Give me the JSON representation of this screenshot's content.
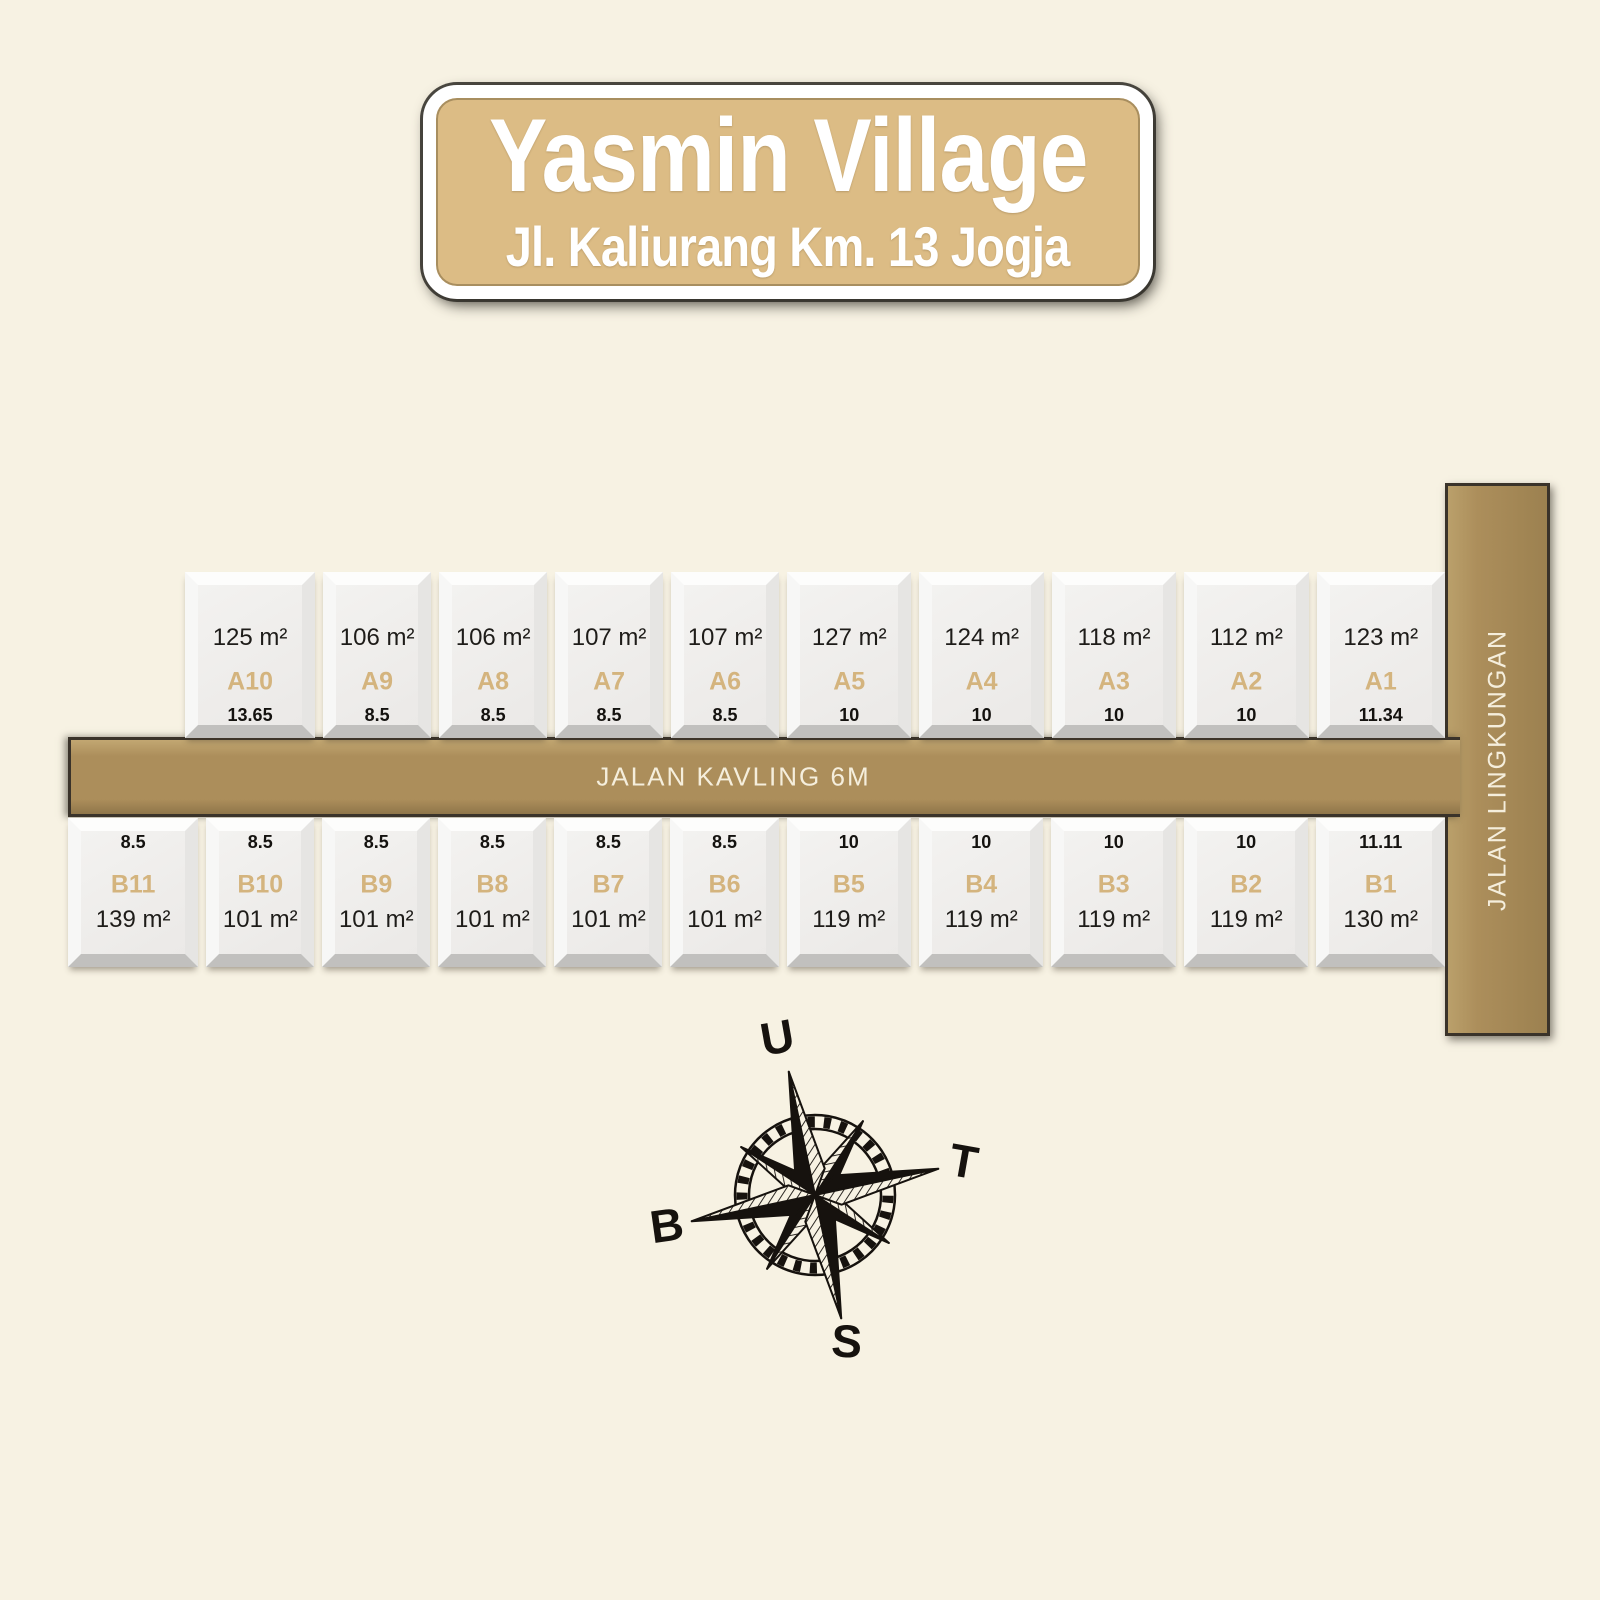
{
  "banner": {
    "title": "Yasmin Village",
    "subtitle": "Jl. Kaliurang Km. 13 Jogja"
  },
  "roads": {
    "horizontal_label": "JALAN KAVLING 6M",
    "vertical_label": "JALAN LINGKUNGAN"
  },
  "plot_rows": {
    "a": [
      {
        "id": "A10",
        "area": "125 m²",
        "frontage": "13.65"
      },
      {
        "id": "A9",
        "area": "106 m²",
        "frontage": "8.5"
      },
      {
        "id": "A8",
        "area": "106 m²",
        "frontage": "8.5"
      },
      {
        "id": "A7",
        "area": "107 m²",
        "frontage": "8.5"
      },
      {
        "id": "A6",
        "area": "107 m²",
        "frontage": "8.5"
      },
      {
        "id": "A5",
        "area": "127 m²",
        "frontage": "10"
      },
      {
        "id": "A4",
        "area": "124 m²",
        "frontage": "10"
      },
      {
        "id": "A3",
        "area": "118 m²",
        "frontage": "10"
      },
      {
        "id": "A2",
        "area": "112 m²",
        "frontage": "10"
      },
      {
        "id": "A1",
        "area": "123 m²",
        "frontage": "11.34"
      }
    ],
    "b": [
      {
        "id": "B11",
        "area": "139 m²",
        "frontage": "8.5"
      },
      {
        "id": "B10",
        "area": "101 m²",
        "frontage": "8.5"
      },
      {
        "id": "B9",
        "area": "101 m²",
        "frontage": "8.5"
      },
      {
        "id": "B8",
        "area": "101 m²",
        "frontage": "8.5"
      },
      {
        "id": "B7",
        "area": "101 m²",
        "frontage": "8.5"
      },
      {
        "id": "B6",
        "area": "101 m²",
        "frontage": "8.5"
      },
      {
        "id": "B5",
        "area": "119 m²",
        "frontage": "10"
      },
      {
        "id": "B4",
        "area": "119 m²",
        "frontage": "10"
      },
      {
        "id": "B3",
        "area": "119 m²",
        "frontage": "10"
      },
      {
        "id": "B2",
        "area": "119 m²",
        "frontage": "10"
      },
      {
        "id": "B1",
        "area": "130 m²",
        "frontage": "11.11"
      }
    ]
  },
  "compass": {
    "north_label": "U",
    "east_label": "T",
    "south_label": "S",
    "west_label": "B"
  },
  "colors": {
    "background": "#f7f2e3",
    "road": "#ac8e5b",
    "banner_fill": "#dcbc85",
    "plot_id_gold": "#d4b47e",
    "compass_ink": "#16120e"
  }
}
